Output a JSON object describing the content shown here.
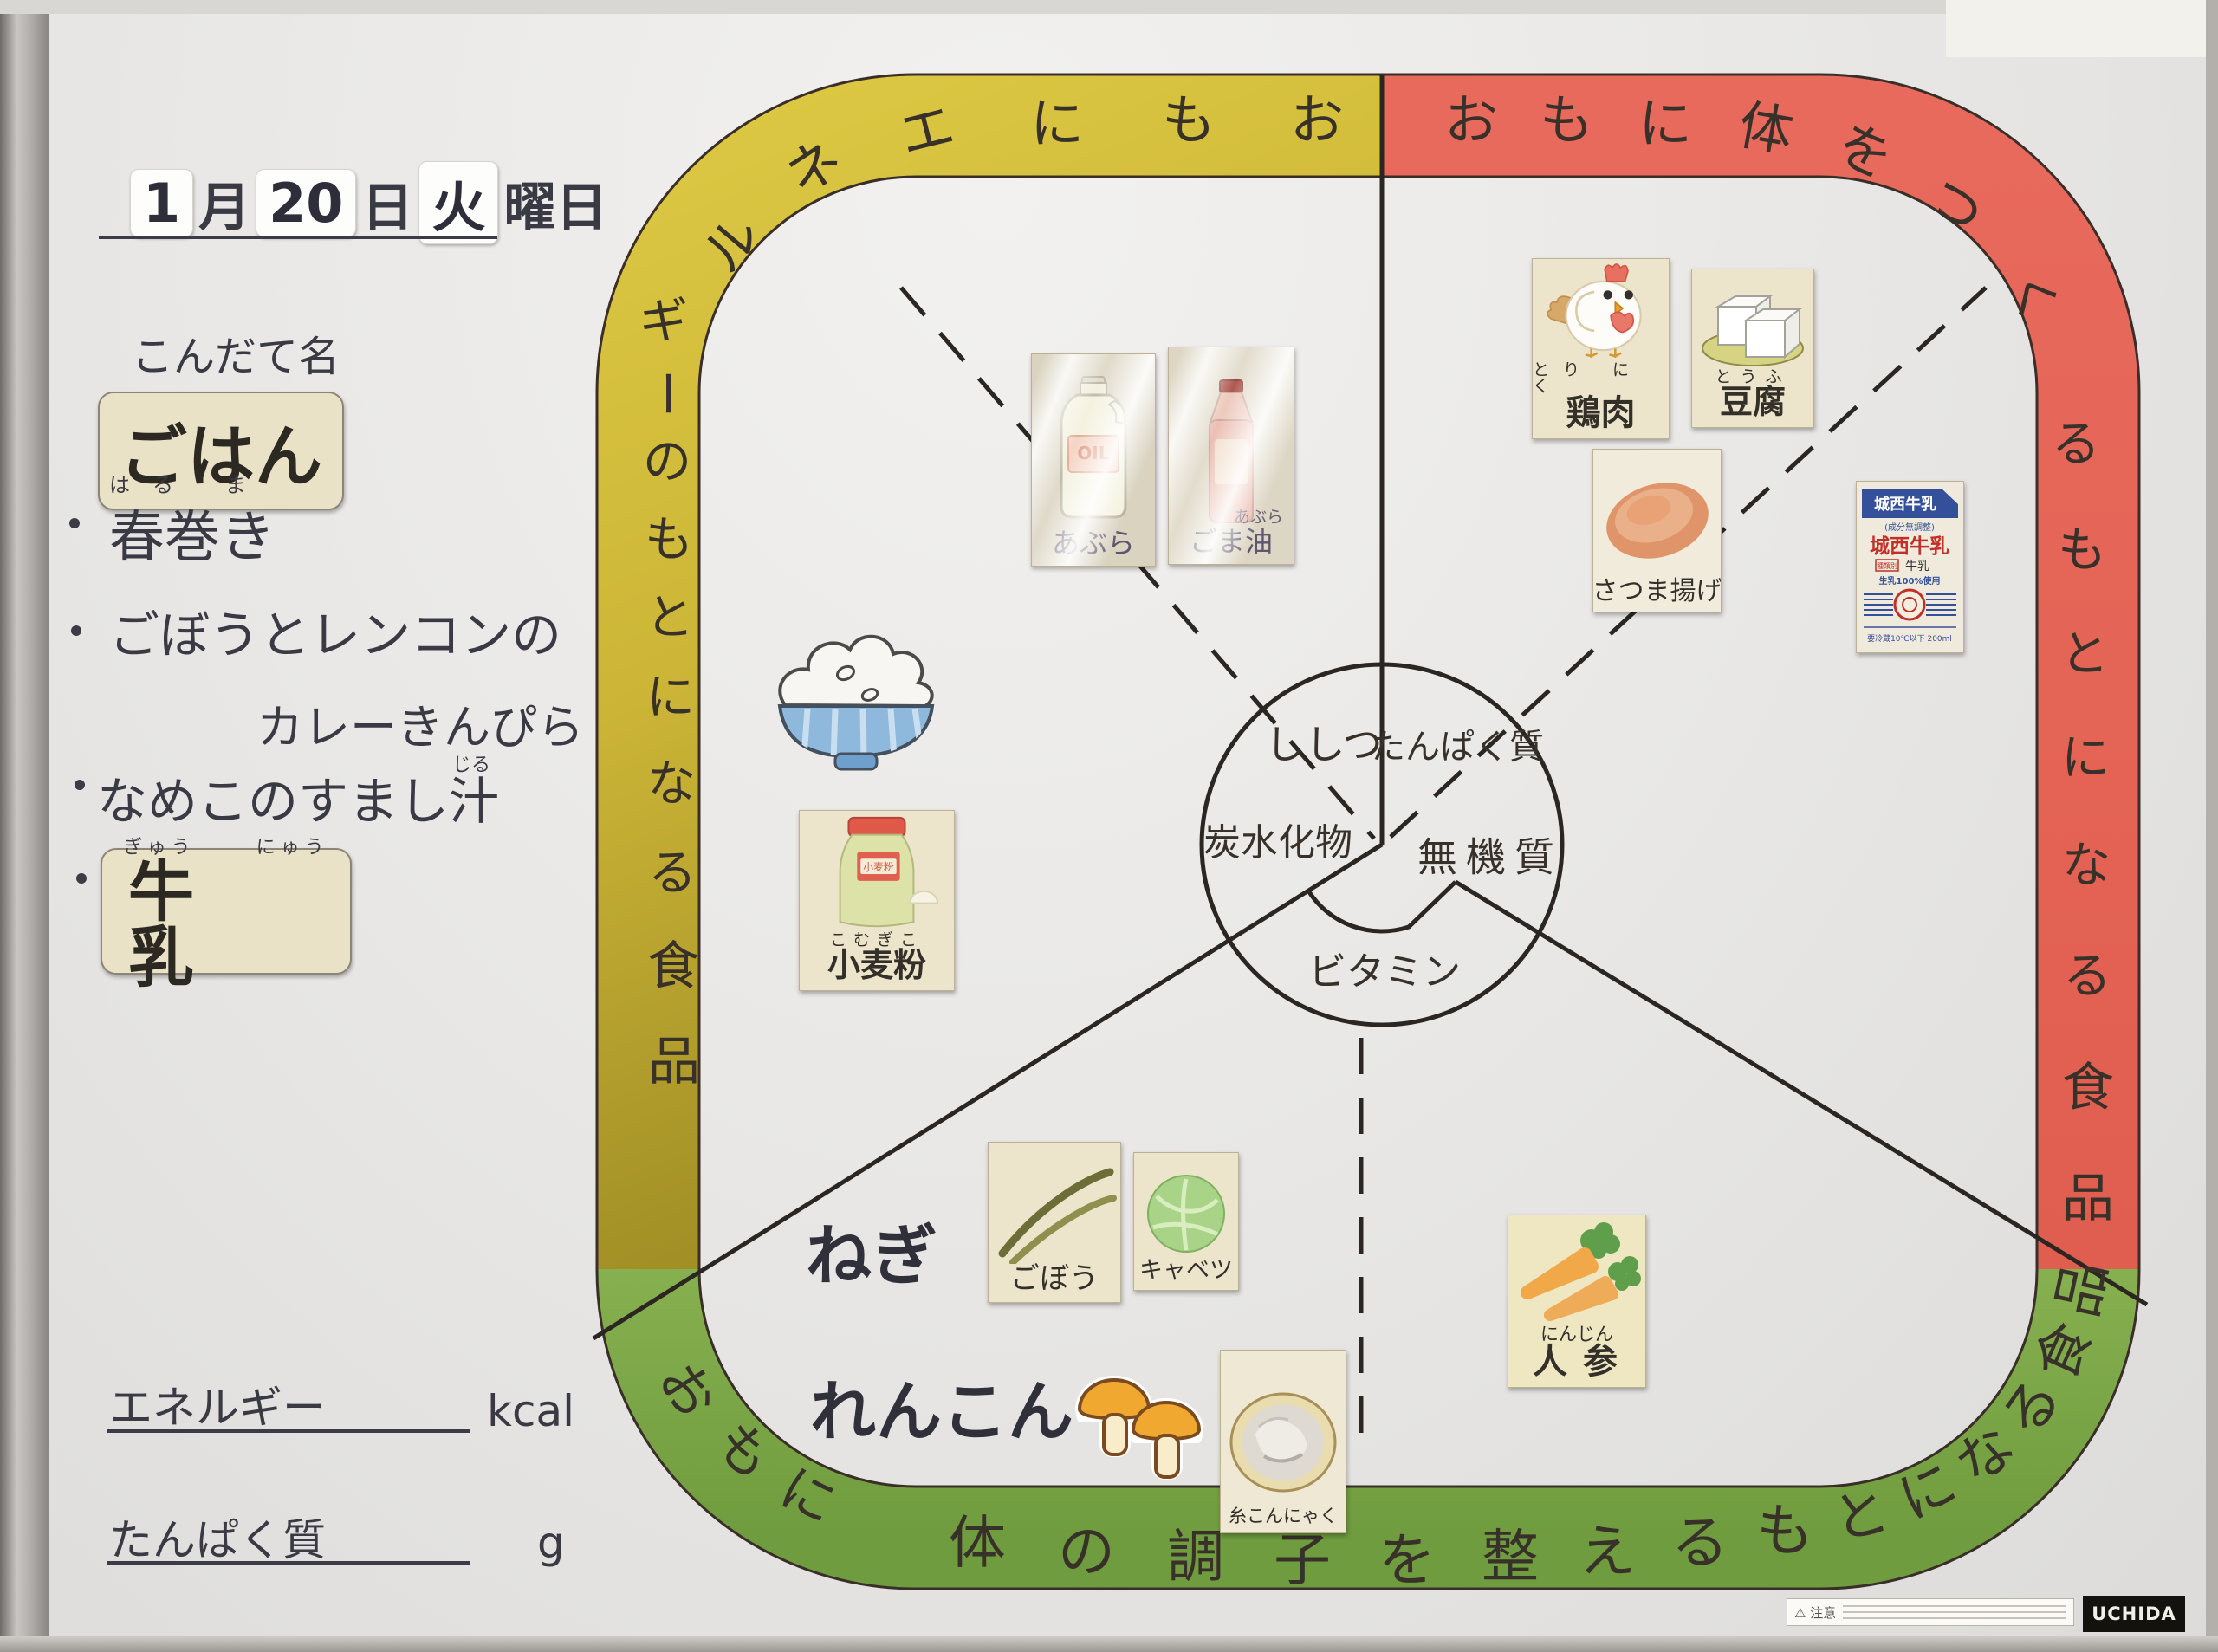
{
  "frame": {
    "brand": "UCHIDA",
    "caution": "注意"
  },
  "header": {
    "month_num": "1",
    "month": "月",
    "day_num": "20",
    "day": "日",
    "weekday": "火",
    "weekday_suffix": "曜日"
  },
  "menu": {
    "heading": "こんだて名",
    "rice": "ごはん",
    "harumaki": {
      "furigana": "はる ま",
      "text": "春巻き"
    },
    "kinpira_line1": "ごぼうとレンコンの",
    "kinpira_line2": "カレーきんぴら",
    "soup": {
      "text": "なめこのすまし",
      "last_char": "汁",
      "furigana": "じる"
    },
    "milk": {
      "furigana_left": "ぎゅう",
      "furigana_right": "にゅう",
      "text": "牛 乳"
    }
  },
  "footer": {
    "energy_label": "エネルギー",
    "energy_unit": "kcal",
    "protein_label": "たんぱく質",
    "protein_unit": "g"
  },
  "diagram": {
    "colors": {
      "yellow": "#d7c23d",
      "yellow_dark": "#9d8b24",
      "red": "#e5695b",
      "green": "#7ca94a"
    },
    "bands": {
      "yellow_label": "おもにエネルギーのもとになる食品",
      "red_label": "おもに体をつくるもとになる食品",
      "green_label": "おもに体の調子を整えるもとになる食品"
    },
    "center": {
      "fat": "ししつ",
      "protein": "たんぱく質",
      "carbohydrate": "炭水化物",
      "mineral": "無機質",
      "vitamin": "ビタミン"
    },
    "cards": {
      "abura": {
        "label": "あぶら",
        "bottle_text": "OIL"
      },
      "gomaabura": {
        "furigana": "あぶら",
        "label": "ごま油"
      },
      "komugiko": {
        "furigana": "こむぎこ",
        "label": "小麦粉"
      },
      "toriniku": {
        "furigana": "とり にく",
        "label": "鶏肉"
      },
      "tofu": {
        "furigana": "とうふ",
        "label": "豆腐"
      },
      "satsumaage": {
        "label": "さつま揚げ"
      },
      "milk_carton": {
        "brand": "城西牛乳",
        "subtitle": "(成分無調整)",
        "brand2": "城西牛乳",
        "type_label": "種類別",
        "type_value": "牛乳",
        "note": "生乳100%使用",
        "storage": "要冷蔵10℃以下 200ml"
      },
      "negi": "ねぎ",
      "gobo": {
        "label": "ごぼう"
      },
      "kyabetsu": {
        "label": "キャベツ"
      },
      "renkon": "れんこん",
      "konnyaku": {
        "label": "糸こんにゃく"
      },
      "ninjin": {
        "furigana": "にんじん",
        "label": "人参"
      }
    }
  }
}
